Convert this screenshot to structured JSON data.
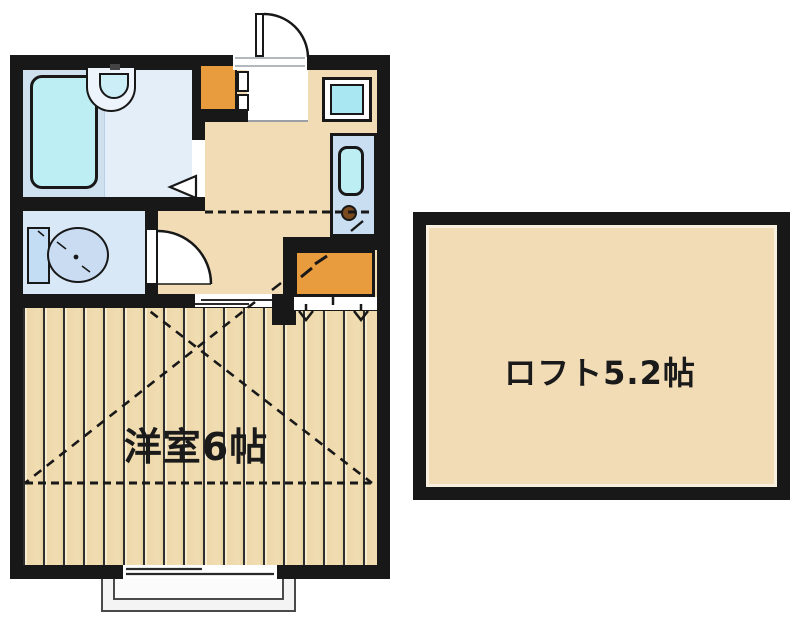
{
  "plan": {
    "rooms": {
      "western_room": {
        "label": "洋室6帖"
      },
      "loft": {
        "label": "ロフト5.2帖"
      }
    },
    "colors": {
      "wall": "#181818",
      "floor_beige": "#f2dcb5",
      "wood_floor": "#eed8ab",
      "cabinet_orange": "#e89c3e",
      "fixture_cyan": "#bceef4",
      "bath_background": "#e3eef8",
      "bathtub_zone": "#cfe0ef",
      "toilet_background": "#d9e8f6",
      "sink_counter": "#cadef1",
      "burner_brown": "#7b4a1e",
      "balcony_gray": "#f4f4f4"
    }
  }
}
